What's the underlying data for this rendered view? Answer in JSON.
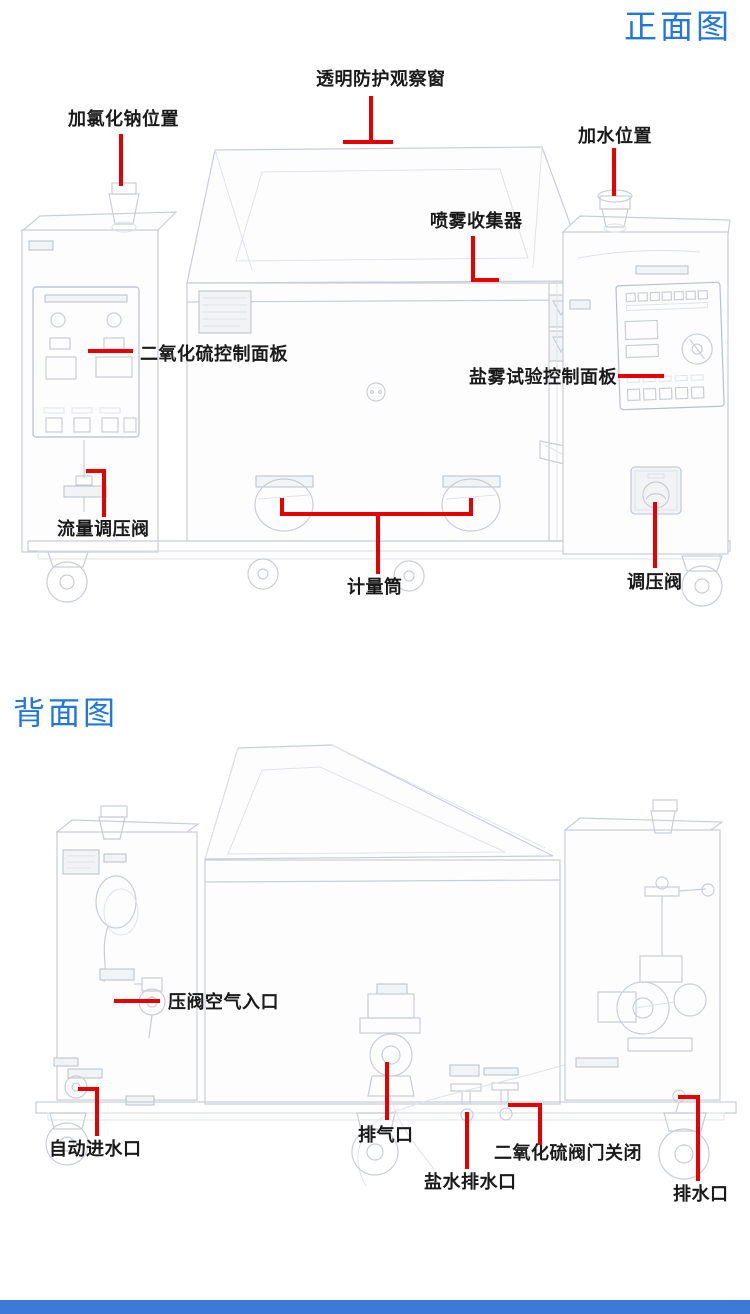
{
  "page": {
    "colors": {
      "accent_blue": "#2277dd",
      "callout_red": "#e60000",
      "label_text": "#1a1a1a",
      "drawing_line": "#c9ced6",
      "footer_bar": "#3d7ad8"
    }
  },
  "front_view": {
    "title": "正面图",
    "labels": [
      {
        "id": "observation-window",
        "text": "透明防护观察窗"
      },
      {
        "id": "nacl-fill-position",
        "text": "加氯化钠位置"
      },
      {
        "id": "water-fill-position",
        "text": "加水位置"
      },
      {
        "id": "spray-collector",
        "text": "喷雾收集器"
      },
      {
        "id": "so2-control-panel",
        "text": "二氧化硫控制面板"
      },
      {
        "id": "salt-spray-control-panel",
        "text": "盐雾试验控制面板"
      },
      {
        "id": "flow-regulator-valve",
        "text": "流量调压阀"
      },
      {
        "id": "measuring-cylinder",
        "text": "计量筒"
      },
      {
        "id": "pressure-regulator-valve",
        "text": "调压阀"
      }
    ]
  },
  "back_view": {
    "title": "背面图",
    "labels": [
      {
        "id": "air-inlet-valve",
        "text": "压阀空气入口"
      },
      {
        "id": "auto-water-inlet",
        "text": "自动进水口"
      },
      {
        "id": "exhaust-port",
        "text": "排气口"
      },
      {
        "id": "salt-water-drain",
        "text": "盐水排水口"
      },
      {
        "id": "so2-valve-closed",
        "text": "二氧化硫阀门关闭"
      },
      {
        "id": "drain-port",
        "text": "排水口"
      }
    ]
  }
}
